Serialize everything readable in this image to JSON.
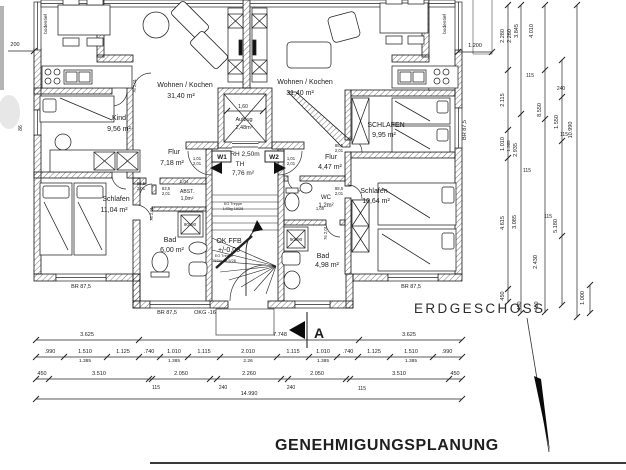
{
  "title": "ERDGESCHOSS",
  "footer": "GENEHMIGUNGSPLANUNG",
  "summary": {
    "apartment_left": [
      {
        "name": "Wohnen / Kochen",
        "area": "31,40 m²"
      },
      {
        "name": "Kind",
        "area": "9,56 m²"
      },
      {
        "name": "Flur",
        "area": "7,18 m²"
      },
      {
        "name": "Schlafen",
        "area": "11,04 m²"
      },
      {
        "name": "Bad",
        "area": "6,00 m²"
      },
      {
        "name": "ABST.",
        "area": "1,0m²"
      }
    ],
    "apartment_right": [
      {
        "name": "Wohnen / Kochen",
        "area": "31,40 m²"
      },
      {
        "name": "SCHLAFEN",
        "area": "9,95 m²"
      },
      {
        "name": "Flur",
        "area": "4,47 m²"
      },
      {
        "name": "Schlafen",
        "area": "10,64 m²"
      },
      {
        "name": "WC",
        "area": "1,2m²"
      },
      {
        "name": "Bad",
        "area": "4,98 m²"
      }
    ],
    "core": [
      {
        "name": "Aufzug",
        "area": "2,48m²"
      },
      {
        "name": "TH",
        "area": "7,76 m²"
      }
    ],
    "notes": [
      "RH 2,50m",
      "OK FFB +/-0,00",
      "OKG -16",
      "BR 87,5",
      "bodentief",
      "W1",
      "W2",
      "90x90"
    ]
  },
  "plan": {
    "labels": [
      {
        "t": "Wohnen / Kochen",
        "x": 185,
        "y": 87,
        "s": 7
      },
      {
        "t": "31,40 m²",
        "x": 181,
        "y": 98,
        "s": 7
      },
      {
        "t": "Wohnen / Kochen",
        "x": 305,
        "y": 84,
        "s": 7
      },
      {
        "t": "31,40 m²",
        "x": 300,
        "y": 95,
        "s": 7
      },
      {
        "t": "Kind",
        "x": 119,
        "y": 120,
        "s": 7
      },
      {
        "t": "9,56 m²",
        "x": 119,
        "y": 131,
        "s": 7
      },
      {
        "t": "Flur",
        "x": 174,
        "y": 154,
        "s": 7
      },
      {
        "t": "7,18 m²",
        "x": 172,
        "y": 165,
        "s": 7
      },
      {
        "t": "Schlafen",
        "x": 116,
        "y": 201,
        "s": 7
      },
      {
        "t": "11,04 m²",
        "x": 114,
        "y": 212,
        "s": 7
      },
      {
        "t": "Bad",
        "x": 170,
        "y": 242,
        "s": 7
      },
      {
        "t": "6,00 m²",
        "x": 172,
        "y": 252,
        "s": 7
      },
      {
        "t": "ABST.",
        "x": 187,
        "y": 193,
        "s": 5
      },
      {
        "t": "1,0m²",
        "x": 187,
        "y": 200,
        "s": 5
      },
      {
        "t": "1,04",
        "x": 184,
        "y": 183,
        "s": 4.5
      },
      {
        "t": "Aufzug",
        "x": 244,
        "y": 121,
        "s": 5.5
      },
      {
        "t": "2,48m²",
        "x": 244,
        "y": 129,
        "s": 5.5
      },
      {
        "t": "1,60",
        "x": 243,
        "y": 108,
        "s": 5
      },
      {
        "t": "RH 2,50m",
        "x": 245,
        "y": 156,
        "s": 6.5
      },
      {
        "t": "TH",
        "x": 240,
        "y": 166,
        "s": 6.5
      },
      {
        "t": "7,76 m²",
        "x": 243,
        "y": 175,
        "s": 6.5
      },
      {
        "t": "W1",
        "x": 222,
        "y": 159,
        "s": 6.5,
        "b": 1
      },
      {
        "t": "W2",
        "x": 274,
        "y": 159,
        "s": 6.5,
        "b": 1
      },
      {
        "t": "OK FFB",
        "x": 229,
        "y": 243,
        "s": 7
      },
      {
        "t": "+/-0,00",
        "x": 229,
        "y": 252,
        "s": 7
      },
      {
        "t": "KG Treppe",
        "x": 233,
        "y": 205,
        "s": 3.8
      },
      {
        "t": "14Stg 18/28",
        "x": 233,
        "y": 210,
        "s": 3.8
      },
      {
        "t": "EG Treppe",
        "x": 224,
        "y": 257,
        "s": 3.8
      },
      {
        "t": "15Stg 18,5/28",
        "x": 224,
        "y": 262,
        "s": 3.8
      },
      {
        "t": "SCHLAFEN",
        "x": 386,
        "y": 127,
        "s": 7
      },
      {
        "t": "9,95 m²",
        "x": 384,
        "y": 137,
        "s": 7
      },
      {
        "t": "Flur",
        "x": 331,
        "y": 159,
        "s": 7
      },
      {
        "t": "4,47 m²",
        "x": 330,
        "y": 169,
        "s": 7
      },
      {
        "t": "Schlafen",
        "x": 374,
        "y": 193,
        "s": 7
      },
      {
        "t": "10,64 m²",
        "x": 376,
        "y": 203,
        "s": 7
      },
      {
        "t": "WC",
        "x": 326,
        "y": 199,
        "s": 6
      },
      {
        "t": "1,2m²",
        "x": 326,
        "y": 207,
        "s": 6
      },
      {
        "t": "Bad",
        "x": 323,
        "y": 258,
        "s": 7
      },
      {
        "t": "4,98 m²",
        "x": 327,
        "y": 267,
        "s": 7
      },
      {
        "t": "90x90",
        "x": 190,
        "y": 226,
        "s": 4.5
      },
      {
        "t": "90x90",
        "x": 296,
        "y": 241,
        "s": 4.5
      },
      {
        "t": "BR 87,5",
        "x": 81,
        "y": 288,
        "s": 5.5
      },
      {
        "t": "BR 87,5",
        "x": 167,
        "y": 314,
        "s": 5.5
      },
      {
        "t": "OKG -16",
        "x": 205,
        "y": 314,
        "s": 5.5
      },
      {
        "t": "BR 87,5",
        "x": 411,
        "y": 288,
        "s": 5.5
      },
      {
        "t": "BR 87,5",
        "x": 466,
        "y": 130,
        "s": 5.5,
        "r": -90
      },
      {
        "t": "86",
        "x": 22,
        "y": 128,
        "s": 5,
        "r": -90
      },
      {
        "t": "bodentief",
        "x": 47,
        "y": 24,
        "s": 4.8,
        "r": -90
      },
      {
        "t": "bodentief",
        "x": 446,
        "y": 24,
        "s": 4.8,
        "r": -90
      },
      {
        "t": "1,01",
        "x": 197,
        "y": 160,
        "s": 4.2
      },
      {
        "t": "2,01",
        "x": 197,
        "y": 165,
        "s": 4.2
      },
      {
        "t": "1,01",
        "x": 291,
        "y": 160,
        "s": 4.2
      },
      {
        "t": "2,01",
        "x": 291,
        "y": 165,
        "s": 4.2
      },
      {
        "t": "88,5",
        "x": 141,
        "y": 185,
        "s": 4.2
      },
      {
        "t": "2,01",
        "x": 141,
        "y": 190,
        "s": 4.2
      },
      {
        "t": "63,5",
        "x": 166,
        "y": 190,
        "s": 4.2
      },
      {
        "t": "2,01",
        "x": 166,
        "y": 195,
        "s": 4.2
      },
      {
        "t": "76 2,01",
        "x": 153,
        "y": 214,
        "s": 4.2,
        "r": -90
      },
      {
        "t": "76 2,01",
        "x": 136,
        "y": 86,
        "s": 4.2,
        "r": -90
      },
      {
        "t": "88,5",
        "x": 339,
        "y": 147,
        "s": 4.2
      },
      {
        "t": "2,01",
        "x": 339,
        "y": 152,
        "s": 4.2
      },
      {
        "t": "88,5",
        "x": 339,
        "y": 190,
        "s": 4.2
      },
      {
        "t": "2,01",
        "x": 339,
        "y": 195,
        "s": 4.2
      },
      {
        "t": "76 2,01",
        "x": 327,
        "y": 233,
        "s": 4.2,
        "r": -90
      },
      {
        "t": "1,00",
        "x": 320,
        "y": 210,
        "s": 4.2
      },
      {
        "t": "200",
        "x": 15,
        "y": 46,
        "s": 5.5
      },
      {
        "t": "1.200",
        "x": 475,
        "y": 47,
        "s": 5.5
      },
      {
        "t": "3.625",
        "x": 87,
        "y": 336,
        "s": 5.5
      },
      {
        "t": "7.748",
        "x": 280,
        "y": 336,
        "s": 5.5
      },
      {
        "t": "3.625",
        "x": 409,
        "y": 336,
        "s": 5.5
      },
      {
        "t": ".990",
        "x": 50,
        "y": 353,
        "s": 5.5
      },
      {
        "t": "1.510",
        "x": 85,
        "y": 353,
        "s": 5.5
      },
      {
        "t": "1.125",
        "x": 123,
        "y": 353,
        "s": 5.5
      },
      {
        "t": ".740",
        "x": 149,
        "y": 353,
        "s": 5.5
      },
      {
        "t": "1.010",
        "x": 174,
        "y": 353,
        "s": 5.5
      },
      {
        "t": "1.115",
        "x": 204,
        "y": 353,
        "s": 5.5
      },
      {
        "t": "2.010",
        "x": 248,
        "y": 353,
        "s": 5.5
      },
      {
        "t": "1.115",
        "x": 293,
        "y": 353,
        "s": 5.5
      },
      {
        "t": "1.010",
        "x": 323,
        "y": 353,
        "s": 5.5
      },
      {
        "t": ".740",
        "x": 348,
        "y": 353,
        "s": 5.5
      },
      {
        "t": "1.125",
        "x": 374,
        "y": 353,
        "s": 5.5
      },
      {
        "t": "1.510",
        "x": 411,
        "y": 353,
        "s": 5.5
      },
      {
        "t": ".990",
        "x": 447,
        "y": 353,
        "s": 5.5
      },
      {
        "t": "1.385",
        "x": 85,
        "y": 362,
        "s": 4.8
      },
      {
        "t": "1.385",
        "x": 174,
        "y": 362,
        "s": 4.8
      },
      {
        "t": "2.26",
        "x": 248,
        "y": 362,
        "s": 4.8
      },
      {
        "t": "1.385",
        "x": 323,
        "y": 362,
        "s": 4.8
      },
      {
        "t": "1.385",
        "x": 411,
        "y": 362,
        "s": 4.8
      },
      {
        "t": "450",
        "x": 42,
        "y": 375,
        "s": 5.5
      },
      {
        "t": "3.510",
        "x": 99,
        "y": 375,
        "s": 5.5
      },
      {
        "t": "2.050",
        "x": 181,
        "y": 375,
        "s": 5.5
      },
      {
        "t": "2.260",
        "x": 249,
        "y": 375,
        "s": 5.5
      },
      {
        "t": "2.050",
        "x": 317,
        "y": 375,
        "s": 5.5
      },
      {
        "t": "3.510",
        "x": 399,
        "y": 375,
        "s": 5.5
      },
      {
        "t": "450",
        "x": 455,
        "y": 375,
        "s": 5.5
      },
      {
        "t": "115",
        "x": 156,
        "y": 389,
        "s": 5
      },
      {
        "t": "240",
        "x": 223,
        "y": 389,
        "s": 5
      },
      {
        "t": "240",
        "x": 291,
        "y": 389,
        "s": 5
      },
      {
        "t": "115",
        "x": 362,
        "y": 390,
        "s": 5
      },
      {
        "t": "14.990",
        "x": 249,
        "y": 395,
        "s": 5.5
      },
      {
        "t": "2.280",
        "x": 504,
        "y": 36,
        "s": 5.5,
        "r": -90
      },
      {
        "t": "2.260",
        "x": 511,
        "y": 36,
        "s": 5.5,
        "r": -90
      },
      {
        "t": "3.845",
        "x": 518,
        "y": 31,
        "s": 5.5,
        "r": -90
      },
      {
        "t": "4.010",
        "x": 533,
        "y": 31,
        "s": 5.5,
        "r": -90
      },
      {
        "t": "2.115",
        "x": 504,
        "y": 100,
        "s": 5.5,
        "r": -90
      },
      {
        "t": "115",
        "x": 530,
        "y": 77,
        "s": 5
      },
      {
        "t": "8.550",
        "x": 541,
        "y": 110,
        "s": 5.5,
        "r": -90
      },
      {
        "t": "240",
        "x": 561,
        "y": 90,
        "s": 5
      },
      {
        "t": "1.010",
        "x": 504,
        "y": 144,
        "s": 5.5,
        "r": -90
      },
      {
        "t": "1.385",
        "x": 510,
        "y": 146,
        "s": 4.5,
        "r": -90
      },
      {
        "t": "2.935",
        "x": 517,
        "y": 150,
        "s": 5.5,
        "r": -90
      },
      {
        "t": "1.550",
        "x": 558,
        "y": 122,
        "s": 5.5,
        "r": -90
      },
      {
        "t": "115",
        "x": 564,
        "y": 136,
        "s": 5
      },
      {
        "t": "10.990",
        "x": 572,
        "y": 130,
        "s": 5.5,
        "r": -90
      },
      {
        "t": "115",
        "x": 527,
        "y": 172,
        "s": 5
      },
      {
        "t": "4.615",
        "x": 504,
        "y": 223,
        "s": 5.5,
        "r": -90
      },
      {
        "t": "3.085",
        "x": 516,
        "y": 222,
        "s": 5.5,
        "r": -90
      },
      {
        "t": "115",
        "x": 548,
        "y": 218,
        "s": 5
      },
      {
        "t": "5.180",
        "x": 557,
        "y": 226,
        "s": 5.5,
        "r": -90
      },
      {
        "t": "2.430",
        "x": 537,
        "y": 262,
        "s": 5.5,
        "r": -90
      },
      {
        "t": "450",
        "x": 504,
        "y": 296,
        "s": 5.5,
        "r": -90
      },
      {
        "t": "450",
        "x": 521,
        "y": 306,
        "s": 5.5,
        "r": -90
      },
      {
        "t": "450",
        "x": 538,
        "y": 306,
        "s": 5.5,
        "r": -90
      },
      {
        "t": "1.000",
        "x": 584,
        "y": 298,
        "s": 5.5,
        "r": -90
      },
      {
        "t": "A",
        "x": 319,
        "y": 338,
        "s": 14,
        "b": 1
      }
    ],
    "dims": [
      {
        "o": "h",
        "p": 340,
        "a": 36,
        "b": 462,
        "ticks": [
          36,
          139,
          359,
          462
        ]
      },
      {
        "o": "h",
        "p": 357,
        "a": 36,
        "b": 462,
        "ticks": [
          36,
          64,
          107,
          139,
          160,
          188,
          220,
          277,
          309,
          337,
          358,
          390,
          433,
          462
        ]
      },
      {
        "o": "h",
        "p": 379,
        "a": 36,
        "b": 462,
        "ticks": [
          36,
          49,
          149,
          152,
          210,
          217,
          281,
          288,
          346,
          350,
          449,
          462
        ]
      },
      {
        "o": "h",
        "p": 399,
        "a": 36,
        "b": 462,
        "ticks": [
          36,
          462
        ]
      },
      {
        "o": "h",
        "p": 51,
        "a": 8,
        "b": 34,
        "ticks": [
          34
        ]
      },
      {
        "o": "h",
        "p": 52,
        "a": 458,
        "b": 492,
        "ticks": [
          458,
          492
        ]
      },
      {
        "o": "h",
        "p": 111,
        "a": 227,
        "b": 263,
        "ticks": [
          227,
          263
        ]
      },
      {
        "o": "v",
        "p": 508,
        "a": 5,
        "b": 302,
        "ticks": [
          5,
          70,
          130,
          158,
          289,
          302
        ]
      },
      {
        "o": "v",
        "p": 521,
        "a": 5,
        "b": 313,
        "ticks": [
          5,
          114,
          313
        ]
      },
      {
        "o": "v",
        "p": 545,
        "a": 5,
        "b": 313,
        "ticks": [
          5,
          70,
          119,
          312
        ]
      },
      {
        "o": "v",
        "p": 562,
        "a": 60,
        "b": 305,
        "ticks": [
          60,
          97,
          141,
          236,
          305
        ]
      },
      {
        "o": "v",
        "p": 577,
        "a": 5,
        "b": 317,
        "ticks": [
          5,
          317
        ]
      },
      {
        "o": "v",
        "p": 590,
        "a": 285,
        "b": 313,
        "ticks": [
          285,
          313
        ]
      }
    ]
  }
}
